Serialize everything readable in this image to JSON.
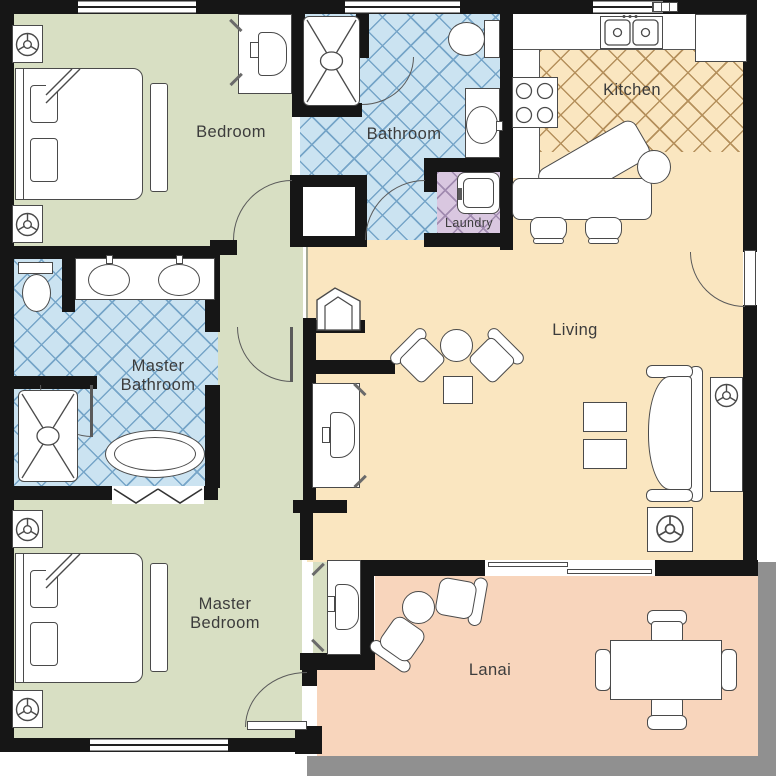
{
  "labels": {
    "bedroom": "Bedroom",
    "bathroom": "Bathroom",
    "kitchen": "Kitchen",
    "laundry": "Laundry",
    "master_bathroom": "Master Bathroom",
    "living": "Living",
    "master_bedroom": "Master Bedroom",
    "lanai": "Lanai"
  },
  "colors": {
    "wall": "#161616",
    "bedroom_floor": "#d8dfc3",
    "bathroom_floor": "#cbe3f1",
    "bathroom_line": "#76a5c8",
    "living_floor": "#fae6c0",
    "kitchen_line": "#b5905c",
    "laundry_floor": "#d9c7e0",
    "laundry_line": "#a18bb0",
    "lanai_floor": "#f8d5bc",
    "railing": "#909090",
    "furniture_line": "#4a4a4a",
    "label_text": "#3c3c3c"
  }
}
